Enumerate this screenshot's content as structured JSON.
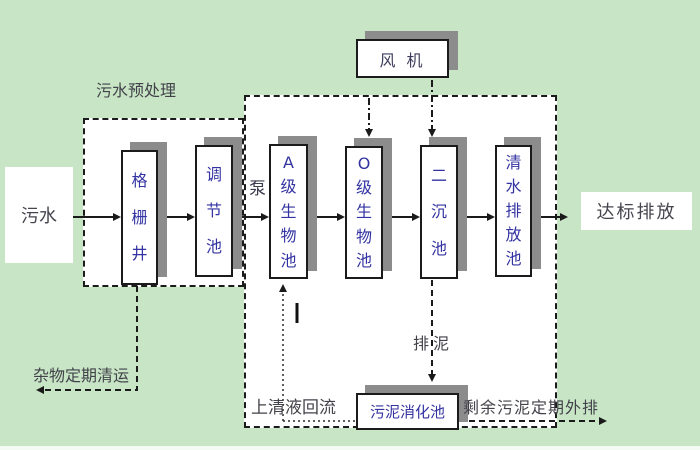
{
  "colors": {
    "background": "#c8e6c6",
    "box_border": "#1b1b1b",
    "box_text": "#3333a2",
    "label_text": "#42424a",
    "shadow": "#8c8c8c",
    "arrow": "#1a1a1a"
  },
  "nodes": {
    "influent": "污水",
    "grid_well": "格栅井",
    "regulating_tank": "调节池",
    "a_bio_tank": "A级生物池",
    "o_bio_tank": "O级生物池",
    "secondary_clarifier": "二沉池",
    "clean_water_tank": "清水排放池",
    "compliant_discharge": "达标排放",
    "fan": "风 机",
    "sludge_digester": "污泥消化池"
  },
  "labels": {
    "pretreatment": "污水预处理",
    "pump": "泵",
    "debris_removal": "杂物定期清运",
    "supernatant_reflux": "上清液回流",
    "sludge_discharge": "排泥",
    "excess_sludge_out": "剩余污泥定期外排"
  }
}
